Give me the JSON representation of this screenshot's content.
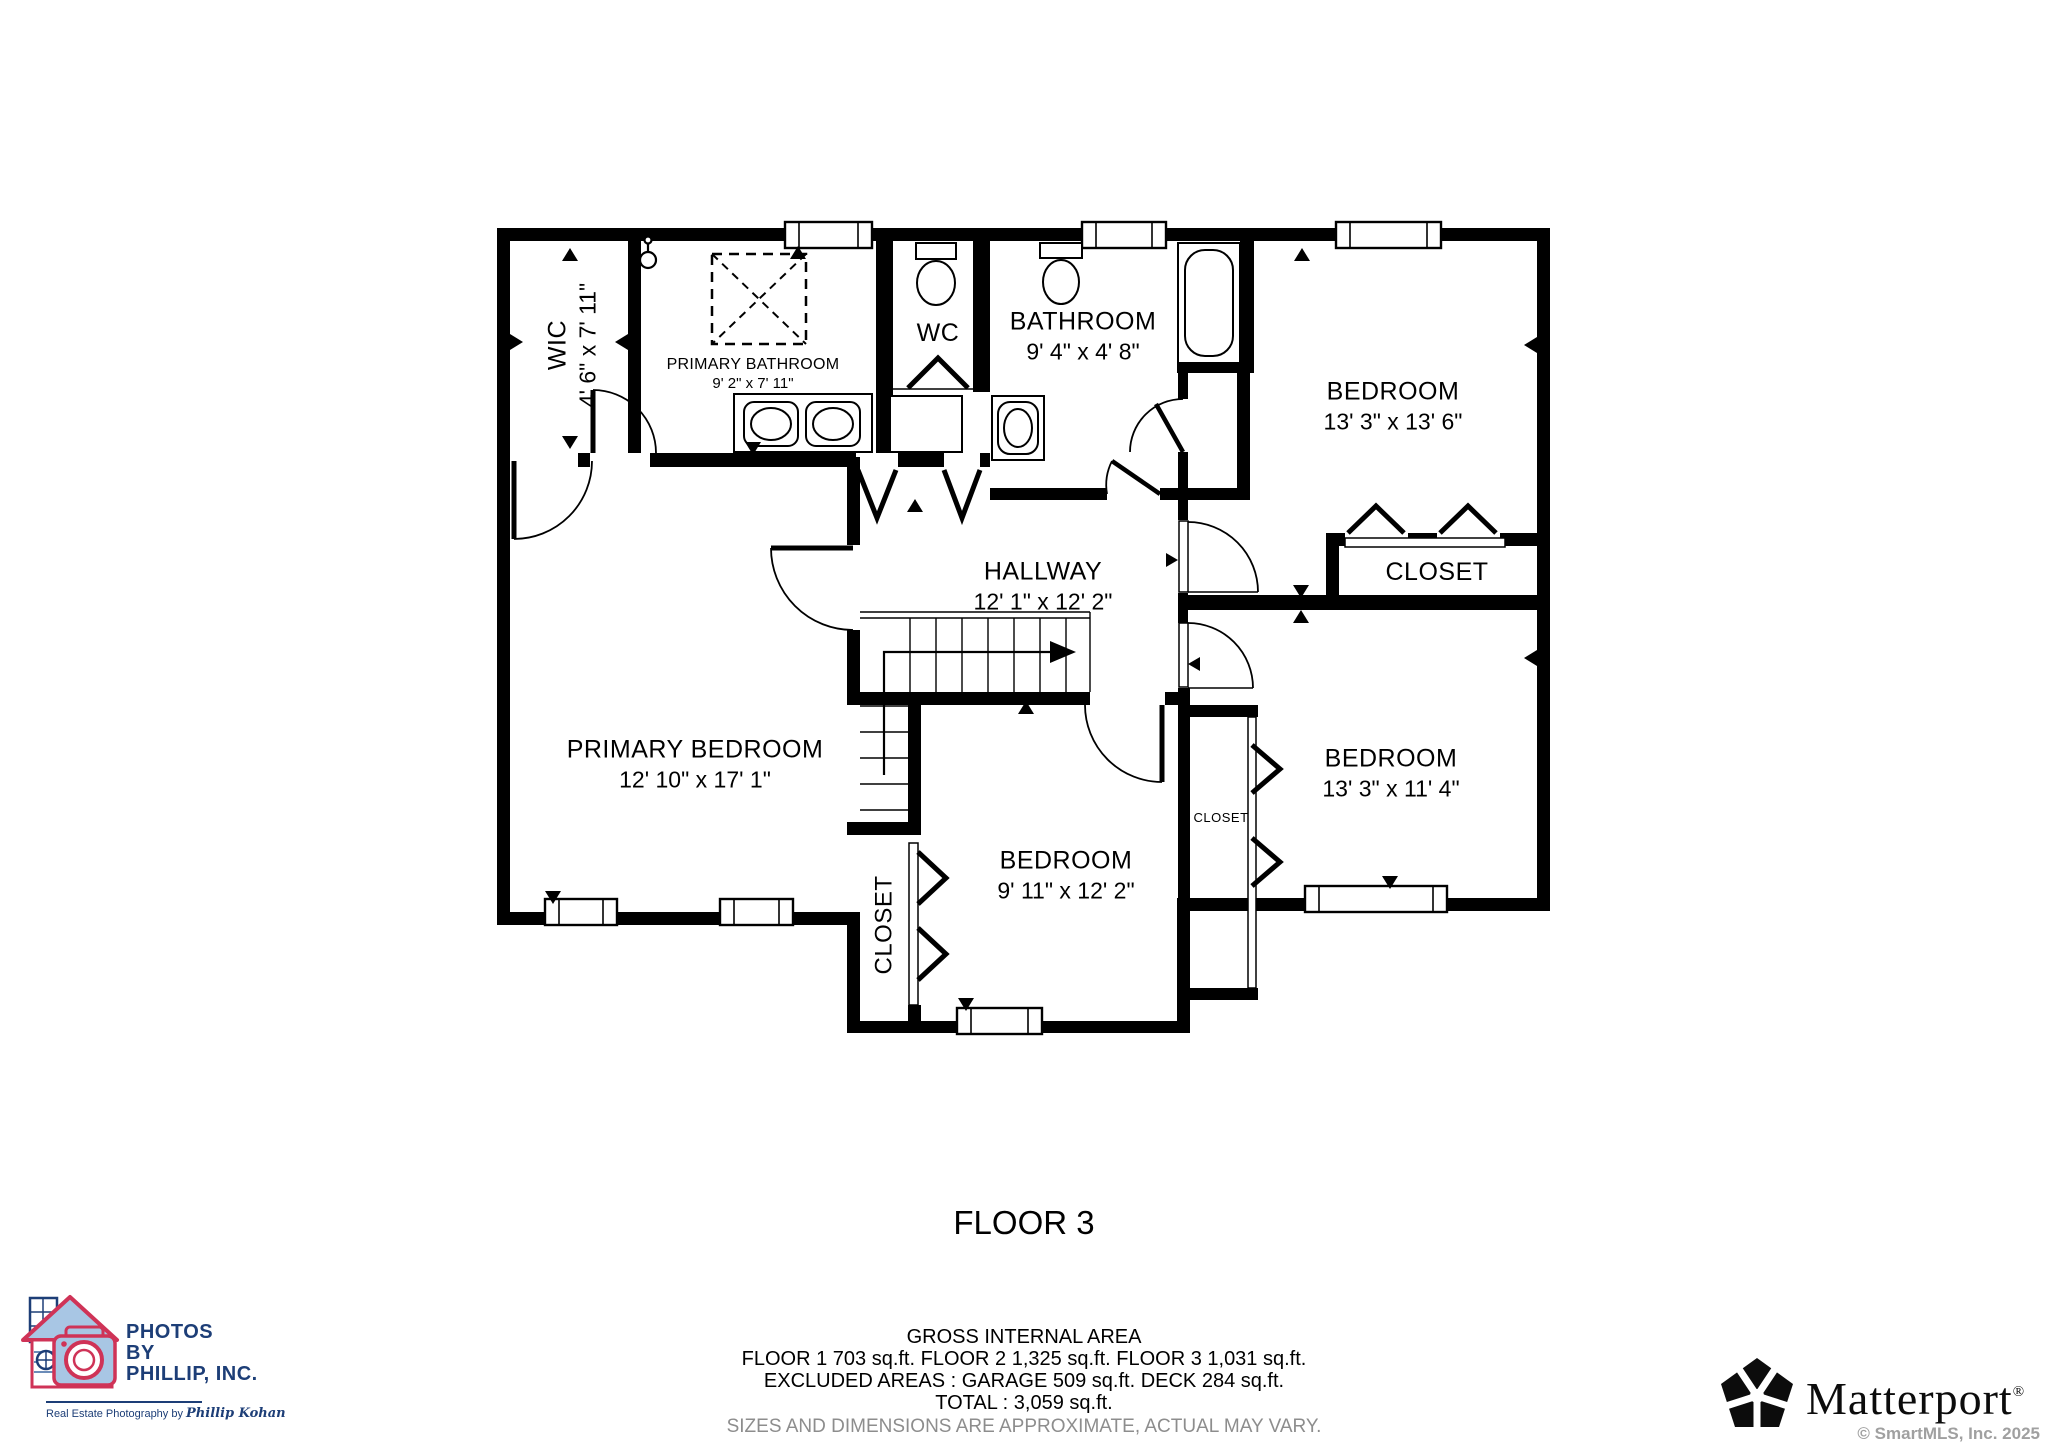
{
  "floor_plan": {
    "title": "FLOOR 3",
    "rooms": [
      {
        "name": "WIC",
        "dims": "4' 6\" x 7' 11\""
      },
      {
        "name": "PRIMARY BATHROOM",
        "dims": "9' 2\" x 7' 11\""
      },
      {
        "name": "WC",
        "dims": ""
      },
      {
        "name": "BATHROOM",
        "dims": "9' 4\" x 4' 8\""
      },
      {
        "name": "BEDROOM",
        "dims": "13' 3\" x 13' 6\""
      },
      {
        "name": "HALLWAY",
        "dims": "12' 1\" x 12' 2\""
      },
      {
        "name": "CLOSET",
        "dims": ""
      },
      {
        "name": "PRIMARY BEDROOM",
        "dims": "12' 10\" x 17' 1\""
      },
      {
        "name": "CLOSET",
        "dims": ""
      },
      {
        "name": "BEDROOM",
        "dims": "9' 11\" x 12' 2\""
      },
      {
        "name": "CLOSET",
        "dims": ""
      },
      {
        "name": "BEDROOM",
        "dims": "13' 3\" x 11' 4\""
      }
    ]
  },
  "footer": {
    "area_title": "GROSS INTERNAL AREA",
    "line1": "FLOOR 1 703 sq.ft.   FLOOR 2 1,325 sq.ft.   FLOOR 3 1,031 sq.ft.",
    "line2": "EXCLUDED AREAS :  GARAGE 509 sq.ft.   DECK 284 sq.ft.",
    "line3": "TOTAL :  3,059 sq.ft.",
    "disclaimer": "SIZES AND DIMENSIONS ARE APPROXIMATE, ACTUAL MAY VARY."
  },
  "branding": {
    "photographer": {
      "line1": "PHOTOS",
      "line2": "BY",
      "line3": "PHILLIP, INC.",
      "tagline_prefix": "Real Estate Photography by ",
      "tagline_script": "Phillip Kohan"
    },
    "matterport": {
      "name": "Matterport",
      "registered": "®",
      "copyright": "© SmartMLS, Inc.  2025"
    }
  },
  "colors": {
    "wall": "#000000",
    "logo_red": "#cf3357",
    "logo_blue_fill": "#a8c6e4",
    "logo_navy": "#1d3e77",
    "disclaimer_gray": "#8d8d8d"
  }
}
